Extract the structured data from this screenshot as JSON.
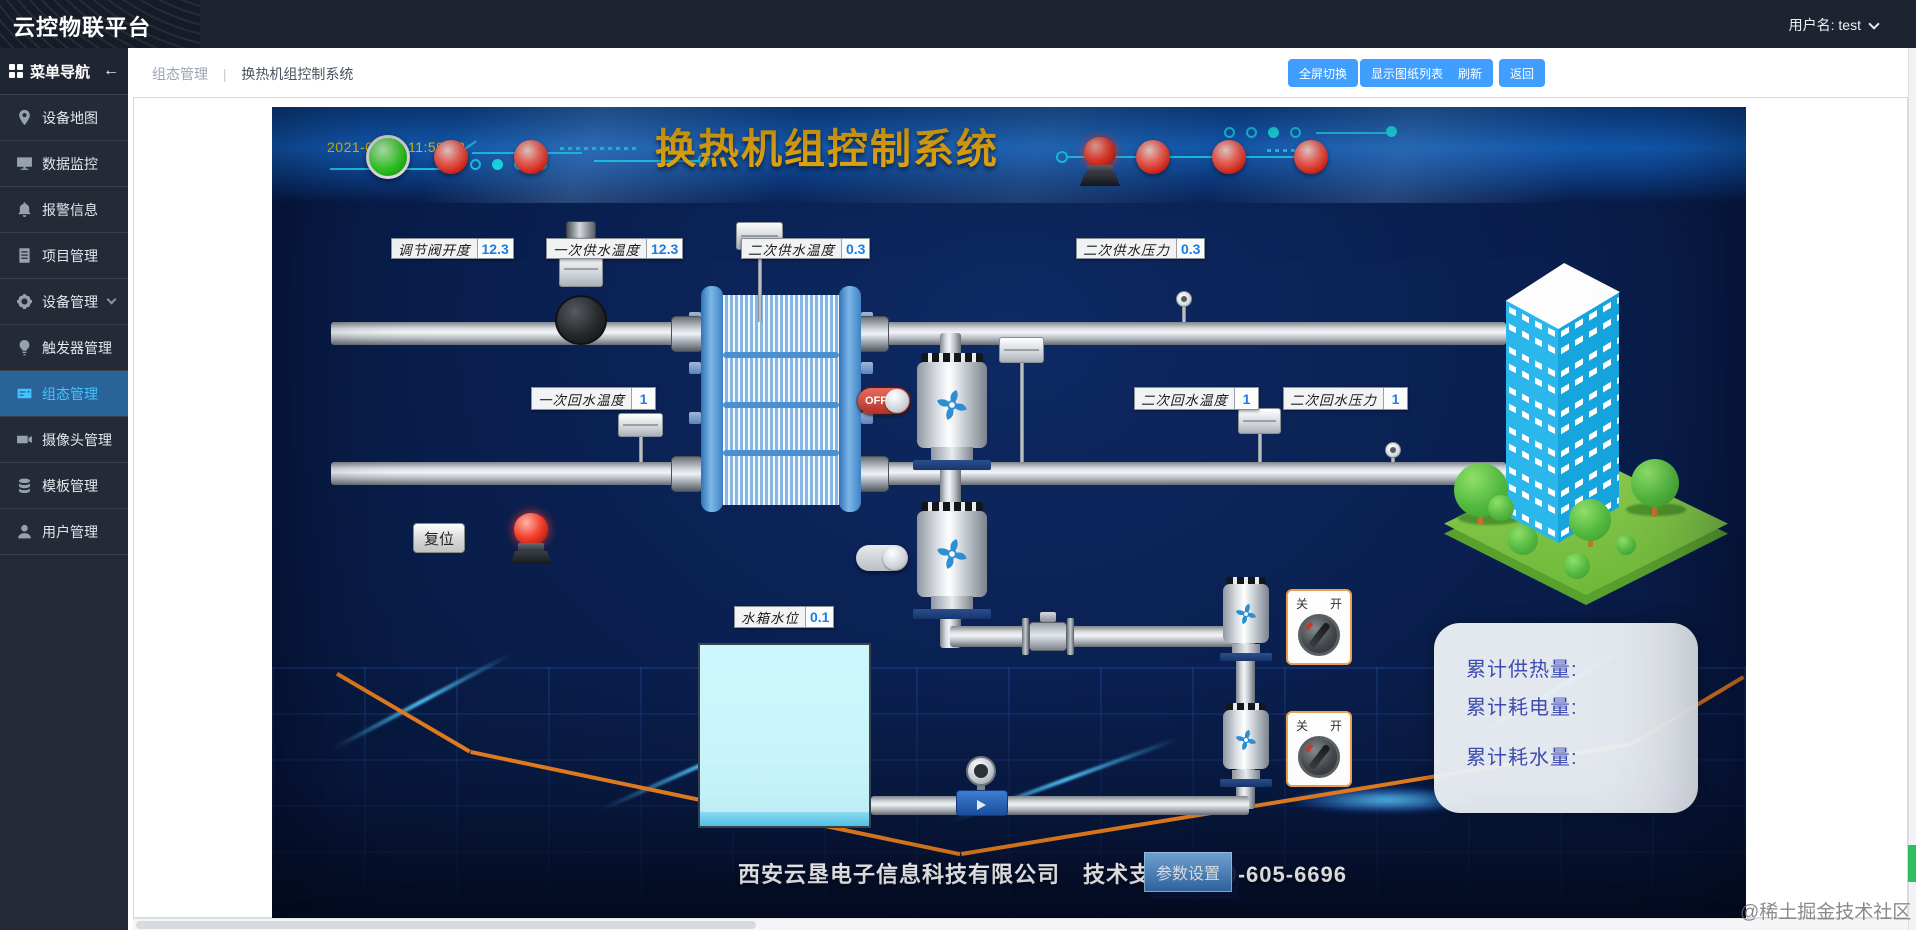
{
  "header": {
    "logo": "云控物联平台",
    "user_label": "用户名: test"
  },
  "sidebar": {
    "nav_title": "菜单导航",
    "back_arrow": "←",
    "items": [
      {
        "label": "设备地图",
        "icon": "map-pin-icon"
      },
      {
        "label": "数据监控",
        "icon": "monitor-icon"
      },
      {
        "label": "报警信息",
        "icon": "bell-icon"
      },
      {
        "label": "项目管理",
        "icon": "project-icon"
      },
      {
        "label": "设备管理",
        "icon": "gear-icon"
      },
      {
        "label": "触发器管理",
        "icon": "trigger-icon"
      },
      {
        "label": "组态管理",
        "icon": "scada-icon",
        "active": true
      },
      {
        "label": "摄像头管理",
        "icon": "camera-icon"
      },
      {
        "label": "模板管理",
        "icon": "template-icon"
      },
      {
        "label": "用户管理",
        "icon": "user-icon"
      }
    ]
  },
  "breadcrumb": {
    "parent": "组态管理",
    "separator": "|",
    "current": "换热机组控制系统"
  },
  "toolbar": {
    "fullscreen": "全屏切换",
    "drawing_list": "显示图纸列表",
    "refresh": "刷新",
    "back": "返回"
  },
  "scada": {
    "timestamp": "2021-09-07 11:59:28",
    "title": "换热机组控制系统",
    "sensors": {
      "valve_opening": {
        "label": "调节阀开度",
        "value": "12.3"
      },
      "supply1_temp": {
        "label": "一次供水温度",
        "value": "12.3"
      },
      "supply2_temp": {
        "label": "二次供水温度",
        "value": "0.3"
      },
      "supply2_press": {
        "label": "二次供水压力",
        "value": "0.3"
      },
      "return1_temp": {
        "label": "一次回水温度",
        "value": "1"
      },
      "return2_temp": {
        "label": "二次回水温度",
        "value": "1"
      },
      "return2_press": {
        "label": "二次回水压力",
        "value": "1"
      },
      "tank_level": {
        "label": "水箱水位",
        "value": "0.1"
      }
    },
    "reset_button": "复位",
    "pump_toggle_off": "OFF",
    "switch_off": "关",
    "switch_on": "开",
    "stats": {
      "heat": "累计供热量:",
      "power": "累计耗电量:",
      "water": "累计耗水量:"
    },
    "footer_text": "西安云垦电子信息科技有限公司　技术支持：400-605-6696",
    "params_button": "参数设置"
  },
  "watermark": "@稀土掘金技术社区",
  "colors": {
    "accent": "#409eff",
    "active_nav": "#42c4ff",
    "scada_title": "#f7b410",
    "value_text": "#1a7ee6",
    "alarm_red": "#e02315",
    "run_green": "#35d626"
  }
}
